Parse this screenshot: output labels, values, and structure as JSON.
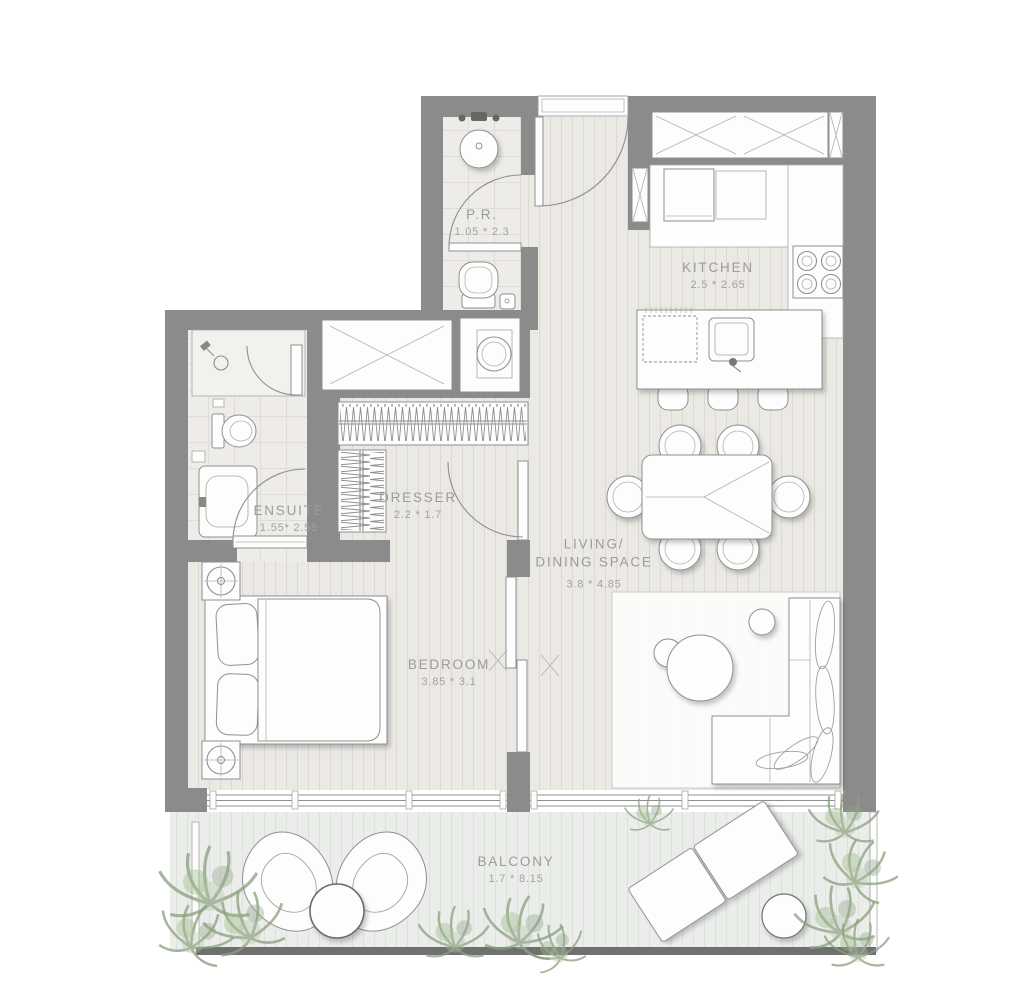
{
  "rooms": {
    "pr": {
      "name": "P.R.",
      "dims": "1.05 * 2.3"
    },
    "kitchen": {
      "name": "KITCHEN",
      "dims": "2.5 * 2.65"
    },
    "ensuite": {
      "name": "ENSUITE",
      "dims": "1.55* 2.55"
    },
    "dresser": {
      "name": "DRESSER",
      "dims": "2.2 * 1.7"
    },
    "living": {
      "name": "LIVING/\nDINING SPACE",
      "dims": "3.8 * 4.85"
    },
    "bedroom": {
      "name": "BEDROOM",
      "dims": "3.85 * 3.1"
    },
    "balcony": {
      "name": "BALCONY",
      "dims": "1.7 * 8.15"
    }
  },
  "colors": {
    "wall": "#8b8b8b",
    "plank_floor": "#ebe9e4",
    "tile_floor": "#edece8",
    "balcony_floor": "#eaedea",
    "outline": "#8f8f8f",
    "label_text": "#9b9b99",
    "plant_green": "#8aa07e",
    "balcony_edge": "#6f6f6f"
  }
}
